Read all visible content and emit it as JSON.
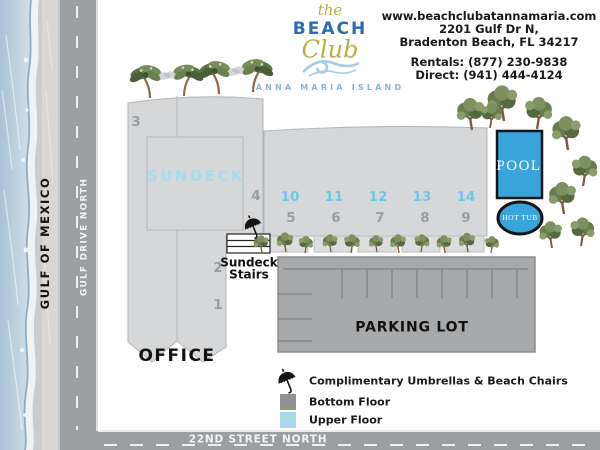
{
  "logo": {
    "the": "the",
    "beach": "BEACH",
    "club": "Club",
    "tagline": "ANNA MARIA ISLAND"
  },
  "contact": {
    "website": "www.beachclubatannamaria.com",
    "address1": "2201 Gulf Dr N,",
    "address2": "Bradenton Beach, FL 34217",
    "rentals": "Rentals: (877) 230-9838",
    "direct": "Direct: (941) 444-4124"
  },
  "streets": {
    "gulf": "GULF OF MEXICO",
    "drive": "GULF DRIVE NORTH",
    "street22": "22ND STREET NORTH"
  },
  "map": {
    "sundeck": "SUNDECK",
    "office": "OFFICE",
    "stairs_line1": "Sundeck",
    "stairs_line2": "Stairs",
    "pool": "POOL",
    "hot_tub": "HOT TUB",
    "parking": "PARKING LOT",
    "left_units": {
      "u1": "1",
      "u2": "2",
      "u3": "3",
      "u4": "4"
    },
    "upper_units": [
      "10",
      "11",
      "12",
      "13",
      "14"
    ],
    "lower_units": [
      "5",
      "6",
      "7",
      "8",
      "9"
    ]
  },
  "legend": {
    "umbrellas": "Complimentary Umbrellas & Beach Chairs",
    "bottom_floor": "Bottom Floor",
    "upper_floor": "Upper Floor"
  },
  "colors": {
    "pool_blue": "#3aa3dc",
    "upper_floor_blue": "#a9d9e8",
    "bottom_floor_gray": "#8f9194",
    "building_gray": "#d6d7d8",
    "road_gray": "#9c9fa2",
    "logo_blue": "#2a6cb3",
    "logo_olive": "#b2b23c",
    "upper_unit_text": "#6ec7e8",
    "lower_unit_text": "#9b9c9e"
  }
}
